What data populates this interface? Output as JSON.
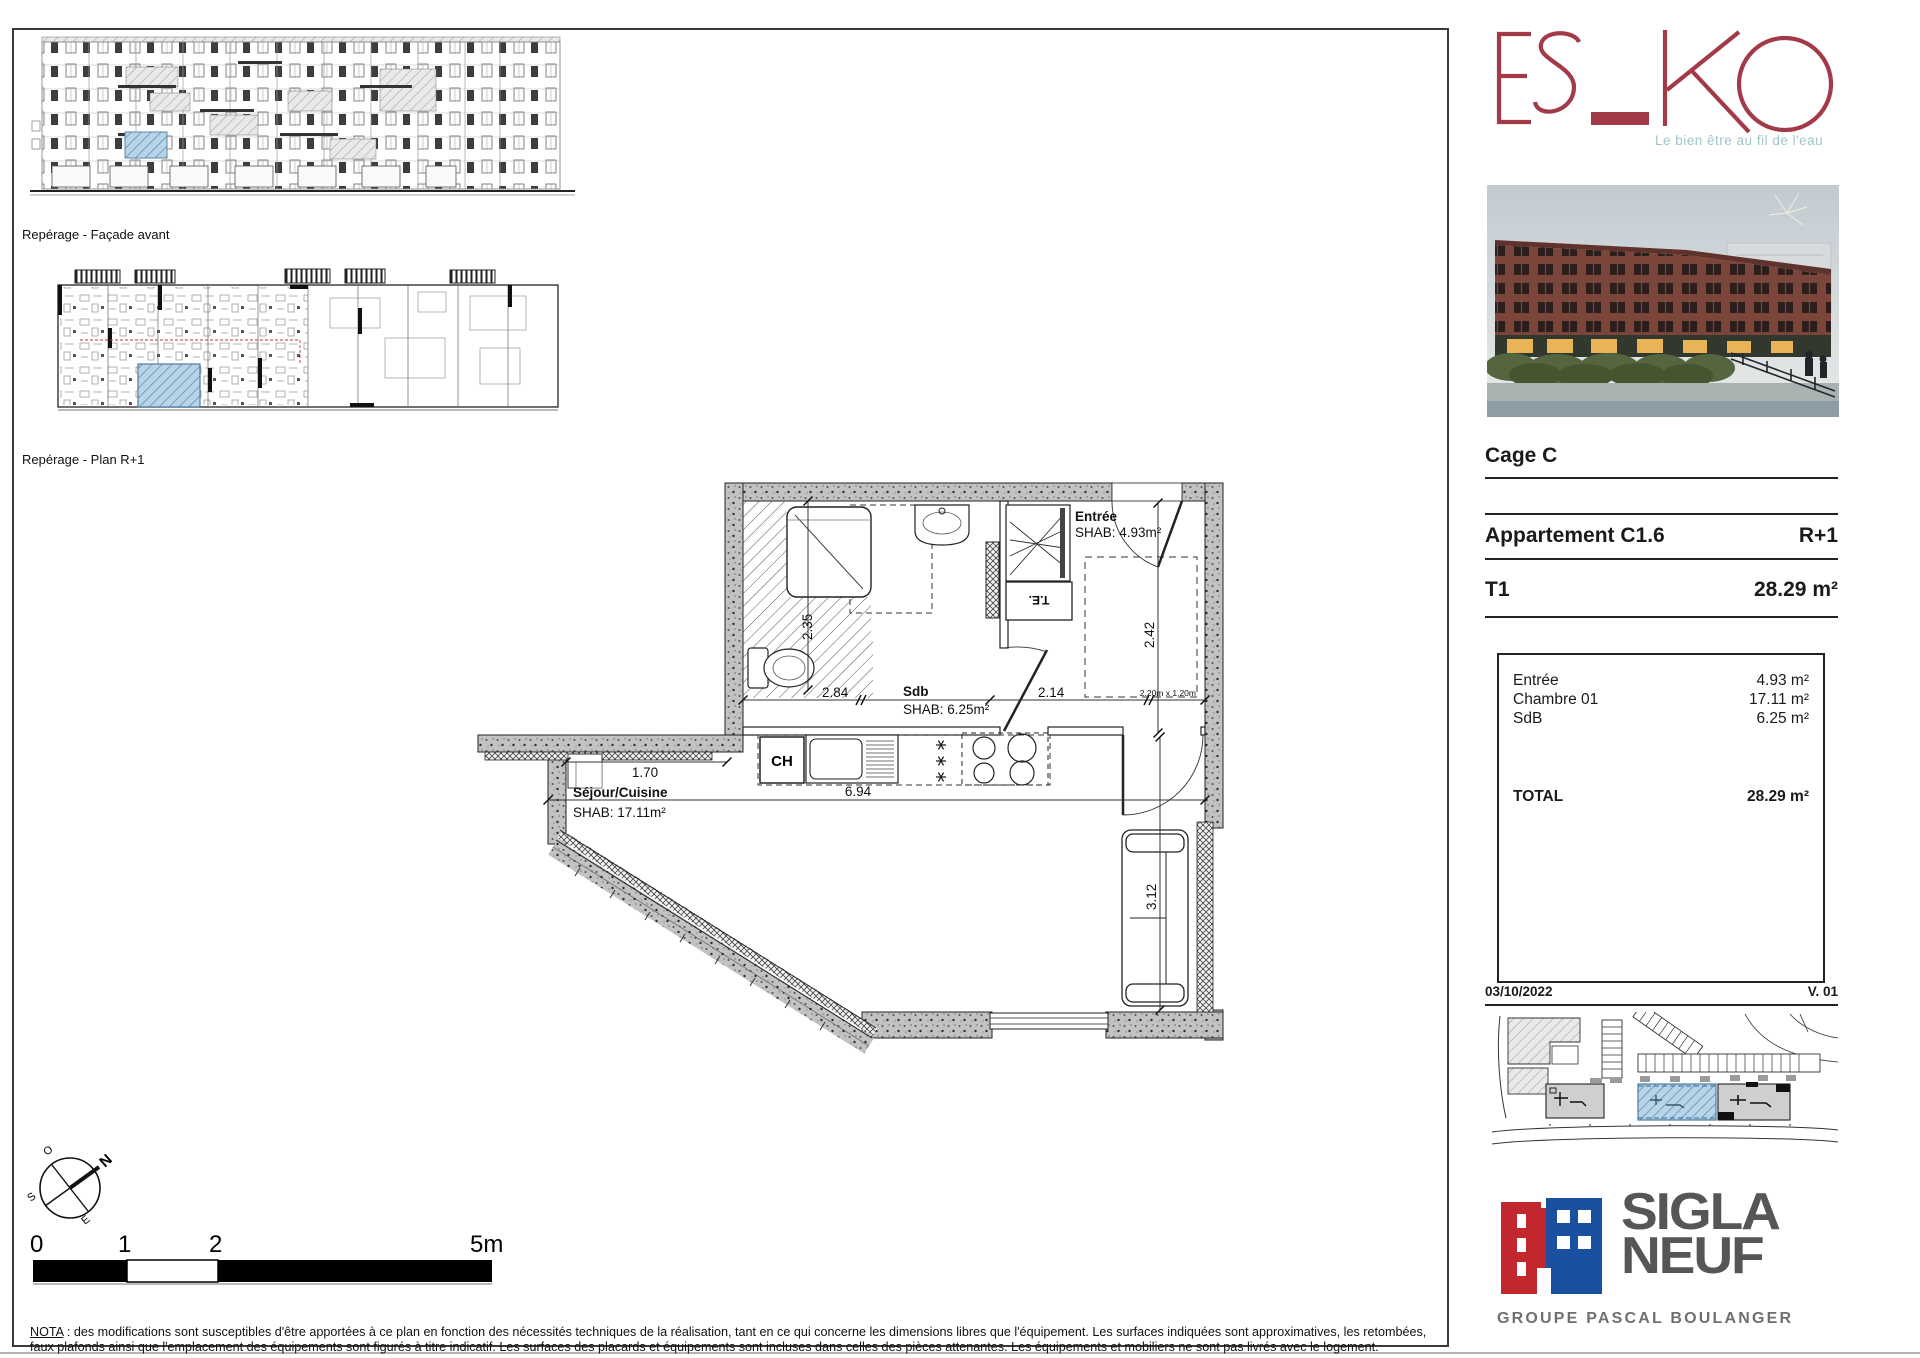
{
  "frame": {
    "facade_label": "Repérage - Façade avant",
    "plan_label": "Repérage - Plan R+1"
  },
  "plan": {
    "rooms": {
      "entree": {
        "name": "Entrée",
        "shab": "SHAB: 4.93m²"
      },
      "sdb": {
        "name": "Sdb",
        "shab": "SHAB: 6.25m²"
      },
      "sejour": {
        "name": "Séjour/Cuisine",
        "shab": "SHAB: 17.11m²"
      }
    },
    "labels": {
      "ch": "CH",
      "te": "T.E.",
      "window_note": "2.20m x 1.20m"
    },
    "dims": {
      "h_sdb": "2.35",
      "w_sdb": "2.84",
      "w_entree": "2.14",
      "h_entree": "2.42",
      "w_wall": "1.70",
      "w_sejour": "6.94",
      "h_sejour": "3.12"
    }
  },
  "compass": {
    "n": "N",
    "o": "O",
    "s": "S",
    "e": "E"
  },
  "scalebar": {
    "t0": "0",
    "t1": "1",
    "t2": "2",
    "t5": "5m"
  },
  "nota": {
    "label": "NOTA",
    "text": " : des modifications sont susceptibles d'être apportées à ce plan en fonction des nécessités techniques de la réalisation, tant en ce qui concerne les dimensions libres que l'équipement. Les surfaces indiquées sont approximatives, les retombées, faux plafonds ainsi que l'emplacement des équipements sont figurés à titre indicatif. Les surfaces des placards et équipements sont incluses dans celles des pièces attenantes. Les équipements et mobiliers ne sont pas livrés avec le logement."
  },
  "sidebar": {
    "logo": {
      "text": "ES_KO",
      "tagline": "Le bien être au fil de l'eau"
    },
    "cage": "Cage C",
    "apartment": "Appartement C1.6",
    "level": "R+1",
    "type": "T1",
    "total_area": "28.29 m²",
    "areas": {
      "rows": [
        {
          "label": "Entrée",
          "value": "4.93 m²"
        },
        {
          "label": "Chambre 01",
          "value": "17.11 m²"
        },
        {
          "label": "SdB",
          "value": "6.25 m²"
        }
      ],
      "total_label": "TOTAL",
      "total_value": "28.29 m²"
    },
    "date": "03/10/2022",
    "version": "V. 01",
    "brand": {
      "name1": "SIGLA",
      "name2": "NEUF",
      "group": "GROUPE PASCAL BOULANGER"
    }
  },
  "colors": {
    "esko_red": "#a23b47",
    "tagline_blue": "#9fc6cc",
    "sigla_gray": "#555658",
    "sigla_red": "#c1272d",
    "sigla_blue": "#1b4f9f",
    "highlight_blue": "#8fbfdf",
    "wall_gray": "#c2c2c2"
  }
}
